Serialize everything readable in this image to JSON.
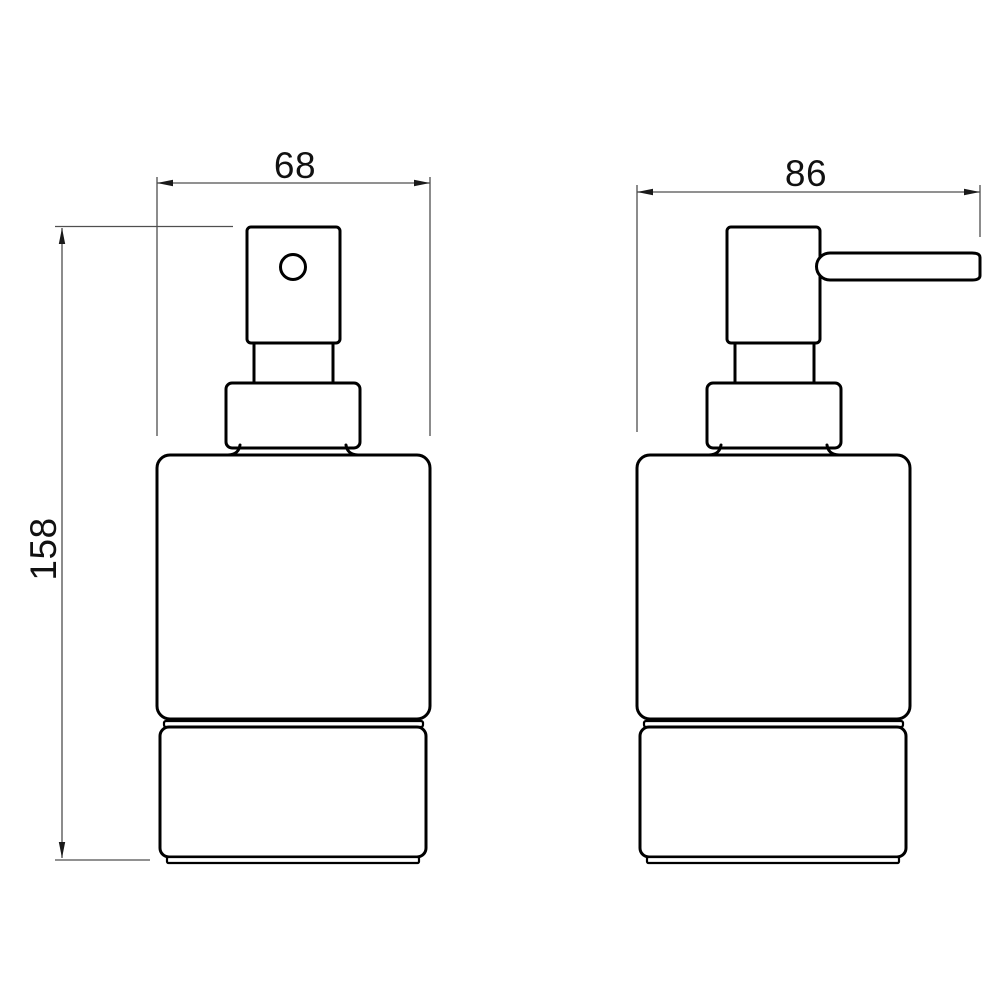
{
  "drawing": {
    "kind": "technical-dimension-drawing",
    "views": [
      {
        "id": "front-view",
        "description": "front elevation of soap dispenser"
      },
      {
        "id": "side-view",
        "description": "side elevation of soap dispenser with spout"
      }
    ]
  },
  "dimensions": {
    "front_width": "68",
    "side_width": "86",
    "height": "158"
  },
  "colors": {
    "background": "#ffffff",
    "object_line": "#000000",
    "dimension_line": "#4f4f4f",
    "arrow": "#1a1a1a",
    "label_text": "#111111"
  }
}
